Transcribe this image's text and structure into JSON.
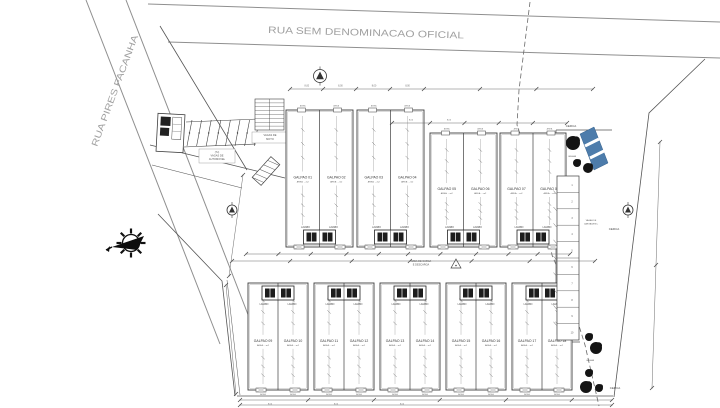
{
  "streets": {
    "top": "RUA SEM DENOMINACAO OFICIAL",
    "left": "RUA PIRES FACANHA"
  },
  "units": {
    "top_row": [
      "GALPAO 01",
      "GALPAO 02",
      "GALPAO 03",
      "GALPAO 04",
      "GALPAO 05",
      "GALPAO 06",
      "GALPAO 07",
      "GALPAO 08"
    ],
    "bottom_row": [
      "GALPAO 09",
      "GALPAO 10",
      "GALPAO 11",
      "GALPAO 12",
      "GALPAO 13",
      "GALPAO 14",
      "GALPAO 15",
      "GALPAO 16",
      "GALPAO 17",
      "GALPAO 18"
    ],
    "area_note": "AREA: ...m2",
    "lavabo": "LAVABO",
    "front_note": "AREA"
  },
  "labels": {
    "fence": "CERCA",
    "grass": "GRAMA",
    "yard_line1": "AREA DE CARGA",
    "yard_line2": "E DESCARGA",
    "car_parking": [
      "(7x)",
      "VAGAS DE",
      "AUTOMOVEL"
    ],
    "moto_parking": [
      "VAGAS DE",
      "MOTO"
    ],
    "loading_stalls": [
      "VAGAS DE",
      "CARGA/DESC."
    ]
  },
  "dims": {
    "bay": "8,00"
  },
  "counts": {
    "car_stalls": 7,
    "moto_rows": 8,
    "loading_rows": 10
  },
  "colors": {
    "line": "#3f3f3f",
    "light": "#8a8a8a",
    "street": "#9f9f9f",
    "tree": "#141414",
    "stripe": "#4d7cab",
    "dark": "#1d1d1d",
    "dim": "#6b6b6b"
  }
}
